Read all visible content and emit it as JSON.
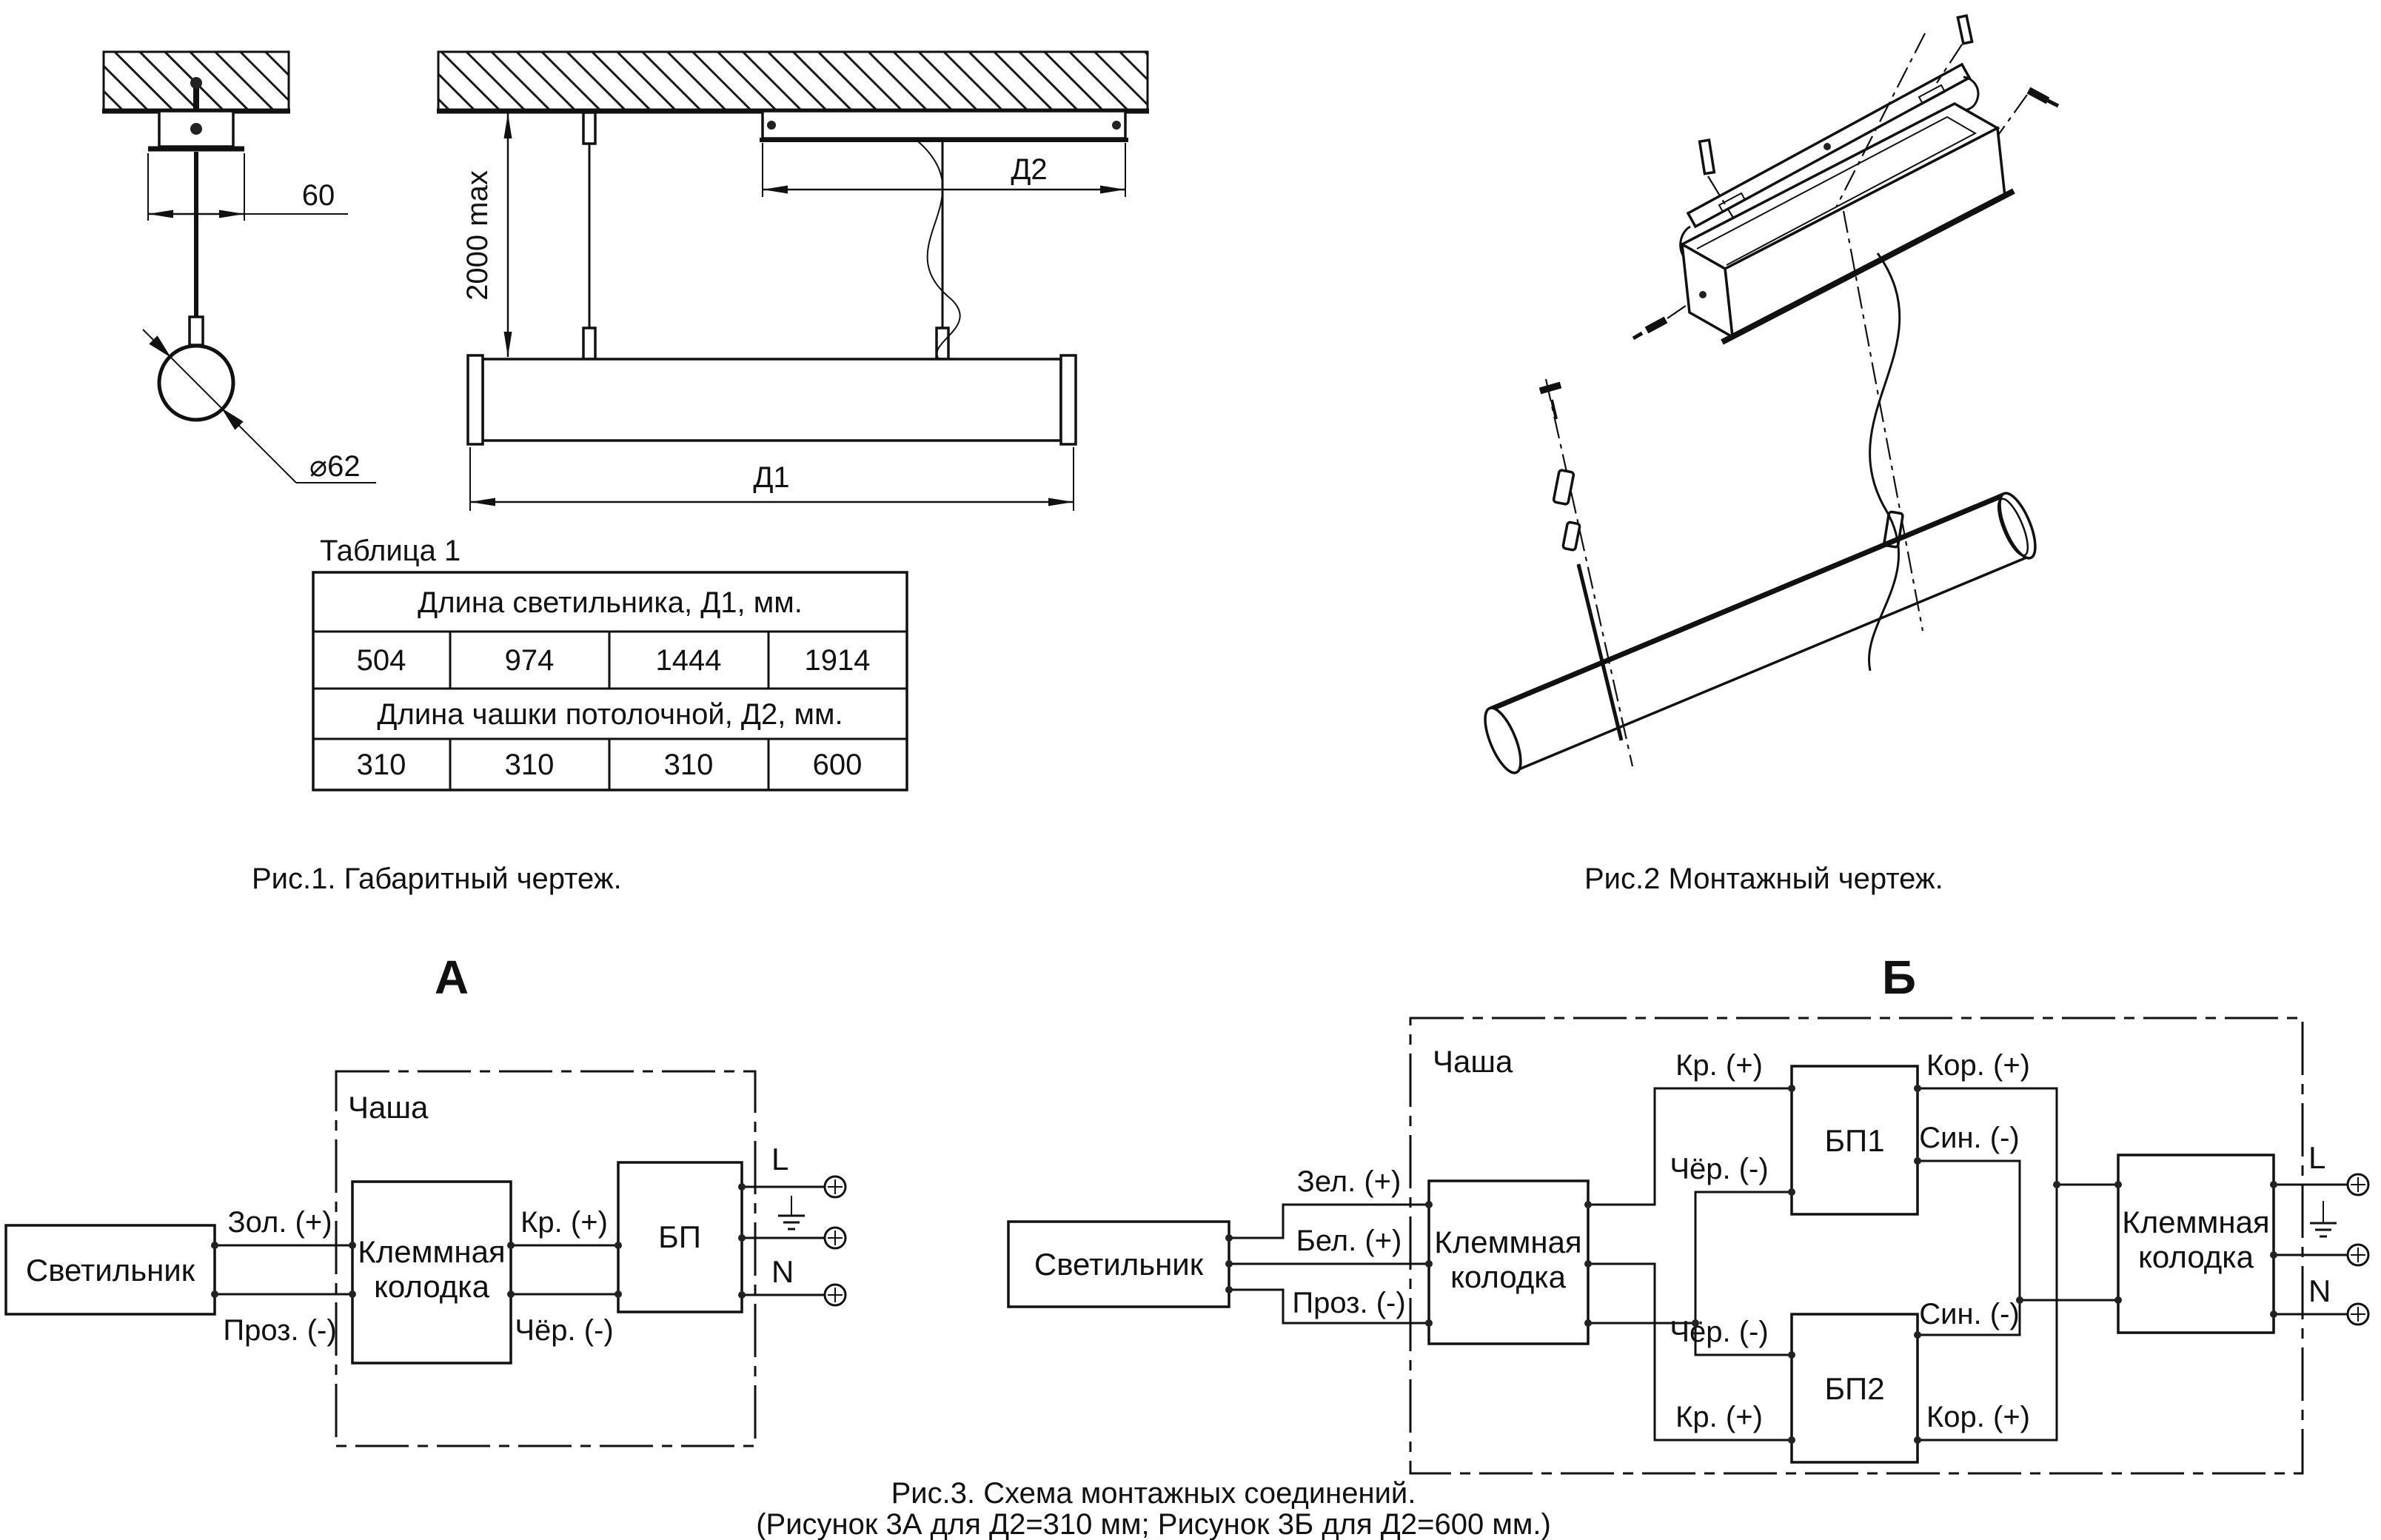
{
  "fig1": {
    "caption": "Рис.1. Габаритный чертеж.",
    "dim_width": "60",
    "dim_diameter": "⌀62",
    "dim_height": "2000 max",
    "dim_d1": "Д1",
    "dim_d2": "Д2"
  },
  "table1": {
    "title": "Таблица 1",
    "header_d1": "Длина светильника, Д1, мм.",
    "d1_values": [
      "504",
      "974",
      "1444",
      "1914"
    ],
    "header_d2": "Длина чашки потолочной, Д2, мм.",
    "d2_values": [
      "310",
      "310",
      "310",
      "600"
    ]
  },
  "fig2": {
    "caption": "Рис.2 Монтажный чертеж."
  },
  "fig3": {
    "caption_line1": "Рис.3. Схема монтажных соединений.",
    "caption_line2": "(Рисунок 3А для Д2=310 мм; Рисунок 3Б для Д2=600 мм.)",
    "variant_a": {
      "label": "А",
      "cup_label": "Чаша",
      "luminaire": "Светильник",
      "terminal_block_line1": "Клеммная",
      "terminal_block_line2": "колодка",
      "psu": "БП",
      "wire_gold": "Зол. (+)",
      "wire_transparent": "Проз. (-)",
      "wire_red": "Кр. (+)",
      "wire_black": "Чёр. (-)",
      "line_terminal": "L",
      "neutral_terminal": "N"
    },
    "variant_b": {
      "label": "Б",
      "cup_label": "Чаша",
      "luminaire": "Светильник",
      "terminal_block_line1": "Клеммная",
      "terminal_block_line2": "колодка",
      "psu1": "БП1",
      "psu2": "БП2",
      "wire_green": "Зел. (+)",
      "wire_white": "Бел. (+)",
      "wire_transparent": "Проз. (-)",
      "wire_red": "Кр. (+)",
      "wire_black": "Чёр. (-)",
      "wire_brown": "Кор. (+)",
      "wire_blue": "Син. (-)",
      "line_terminal": "L",
      "neutral_terminal": "N"
    }
  }
}
